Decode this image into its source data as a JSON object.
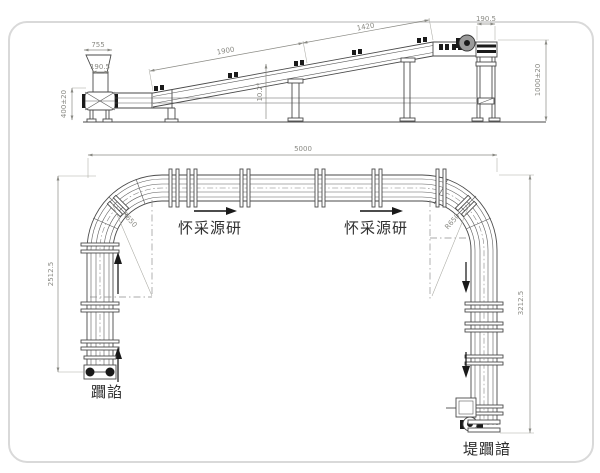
{
  "colors": {
    "background": "#ffffff",
    "structure_line": "#4a4a4a",
    "dimension_line": "#8a8a84",
    "annotation_text": "#2f2f2f",
    "solid_fill": "#1a1a1a",
    "frame_border": "#d9d9d9"
  },
  "side_view": {
    "dims": {
      "hopper_top_width": "755",
      "hopper_outlet_width": "190.5",
      "infeed_height": "400±20",
      "incline_length_lower": "1900",
      "incline_length_upper": "1420",
      "incline_angle": "10.2°",
      "head_pulley_width": "190.5",
      "discharge_height": "1000±20"
    }
  },
  "plan_view": {
    "dims": {
      "overall_length": "5000",
      "left_leg_length": "2512.5",
      "right_leg_length": "3212.5",
      "corner_radius_left": "R650",
      "corner_radius_right": "R650"
    },
    "labels": {
      "flow_text_left": "怀采源研",
      "flow_text_right": "怀采源研",
      "infeed_label": "躢諂",
      "discharge_label": "堤躢諳"
    }
  }
}
